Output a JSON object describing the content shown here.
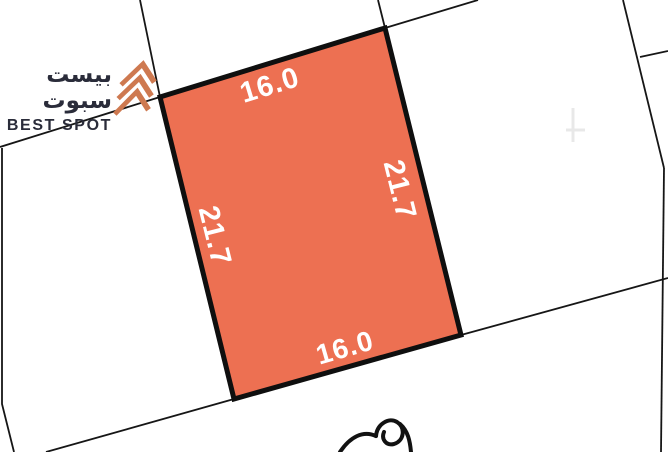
{
  "logo": {
    "title_ar": "بيست سبوت",
    "title_en": "BEST SPOT"
  },
  "plot": {
    "dimensions": {
      "top": "16.0",
      "right": "21.7",
      "bottom": "16.0",
      "left": "21.7"
    }
  },
  "colors": {
    "background": "#FFFFFF",
    "parcel_fill": "#ED7052",
    "parcel_border": "#0F0F0F",
    "boundary_line": "#161616",
    "label_text": "#FFFFFF",
    "logo_text": "#2A2C3A",
    "logo_mark": "#CE7950",
    "faint_mark": "#E8E8E8"
  }
}
